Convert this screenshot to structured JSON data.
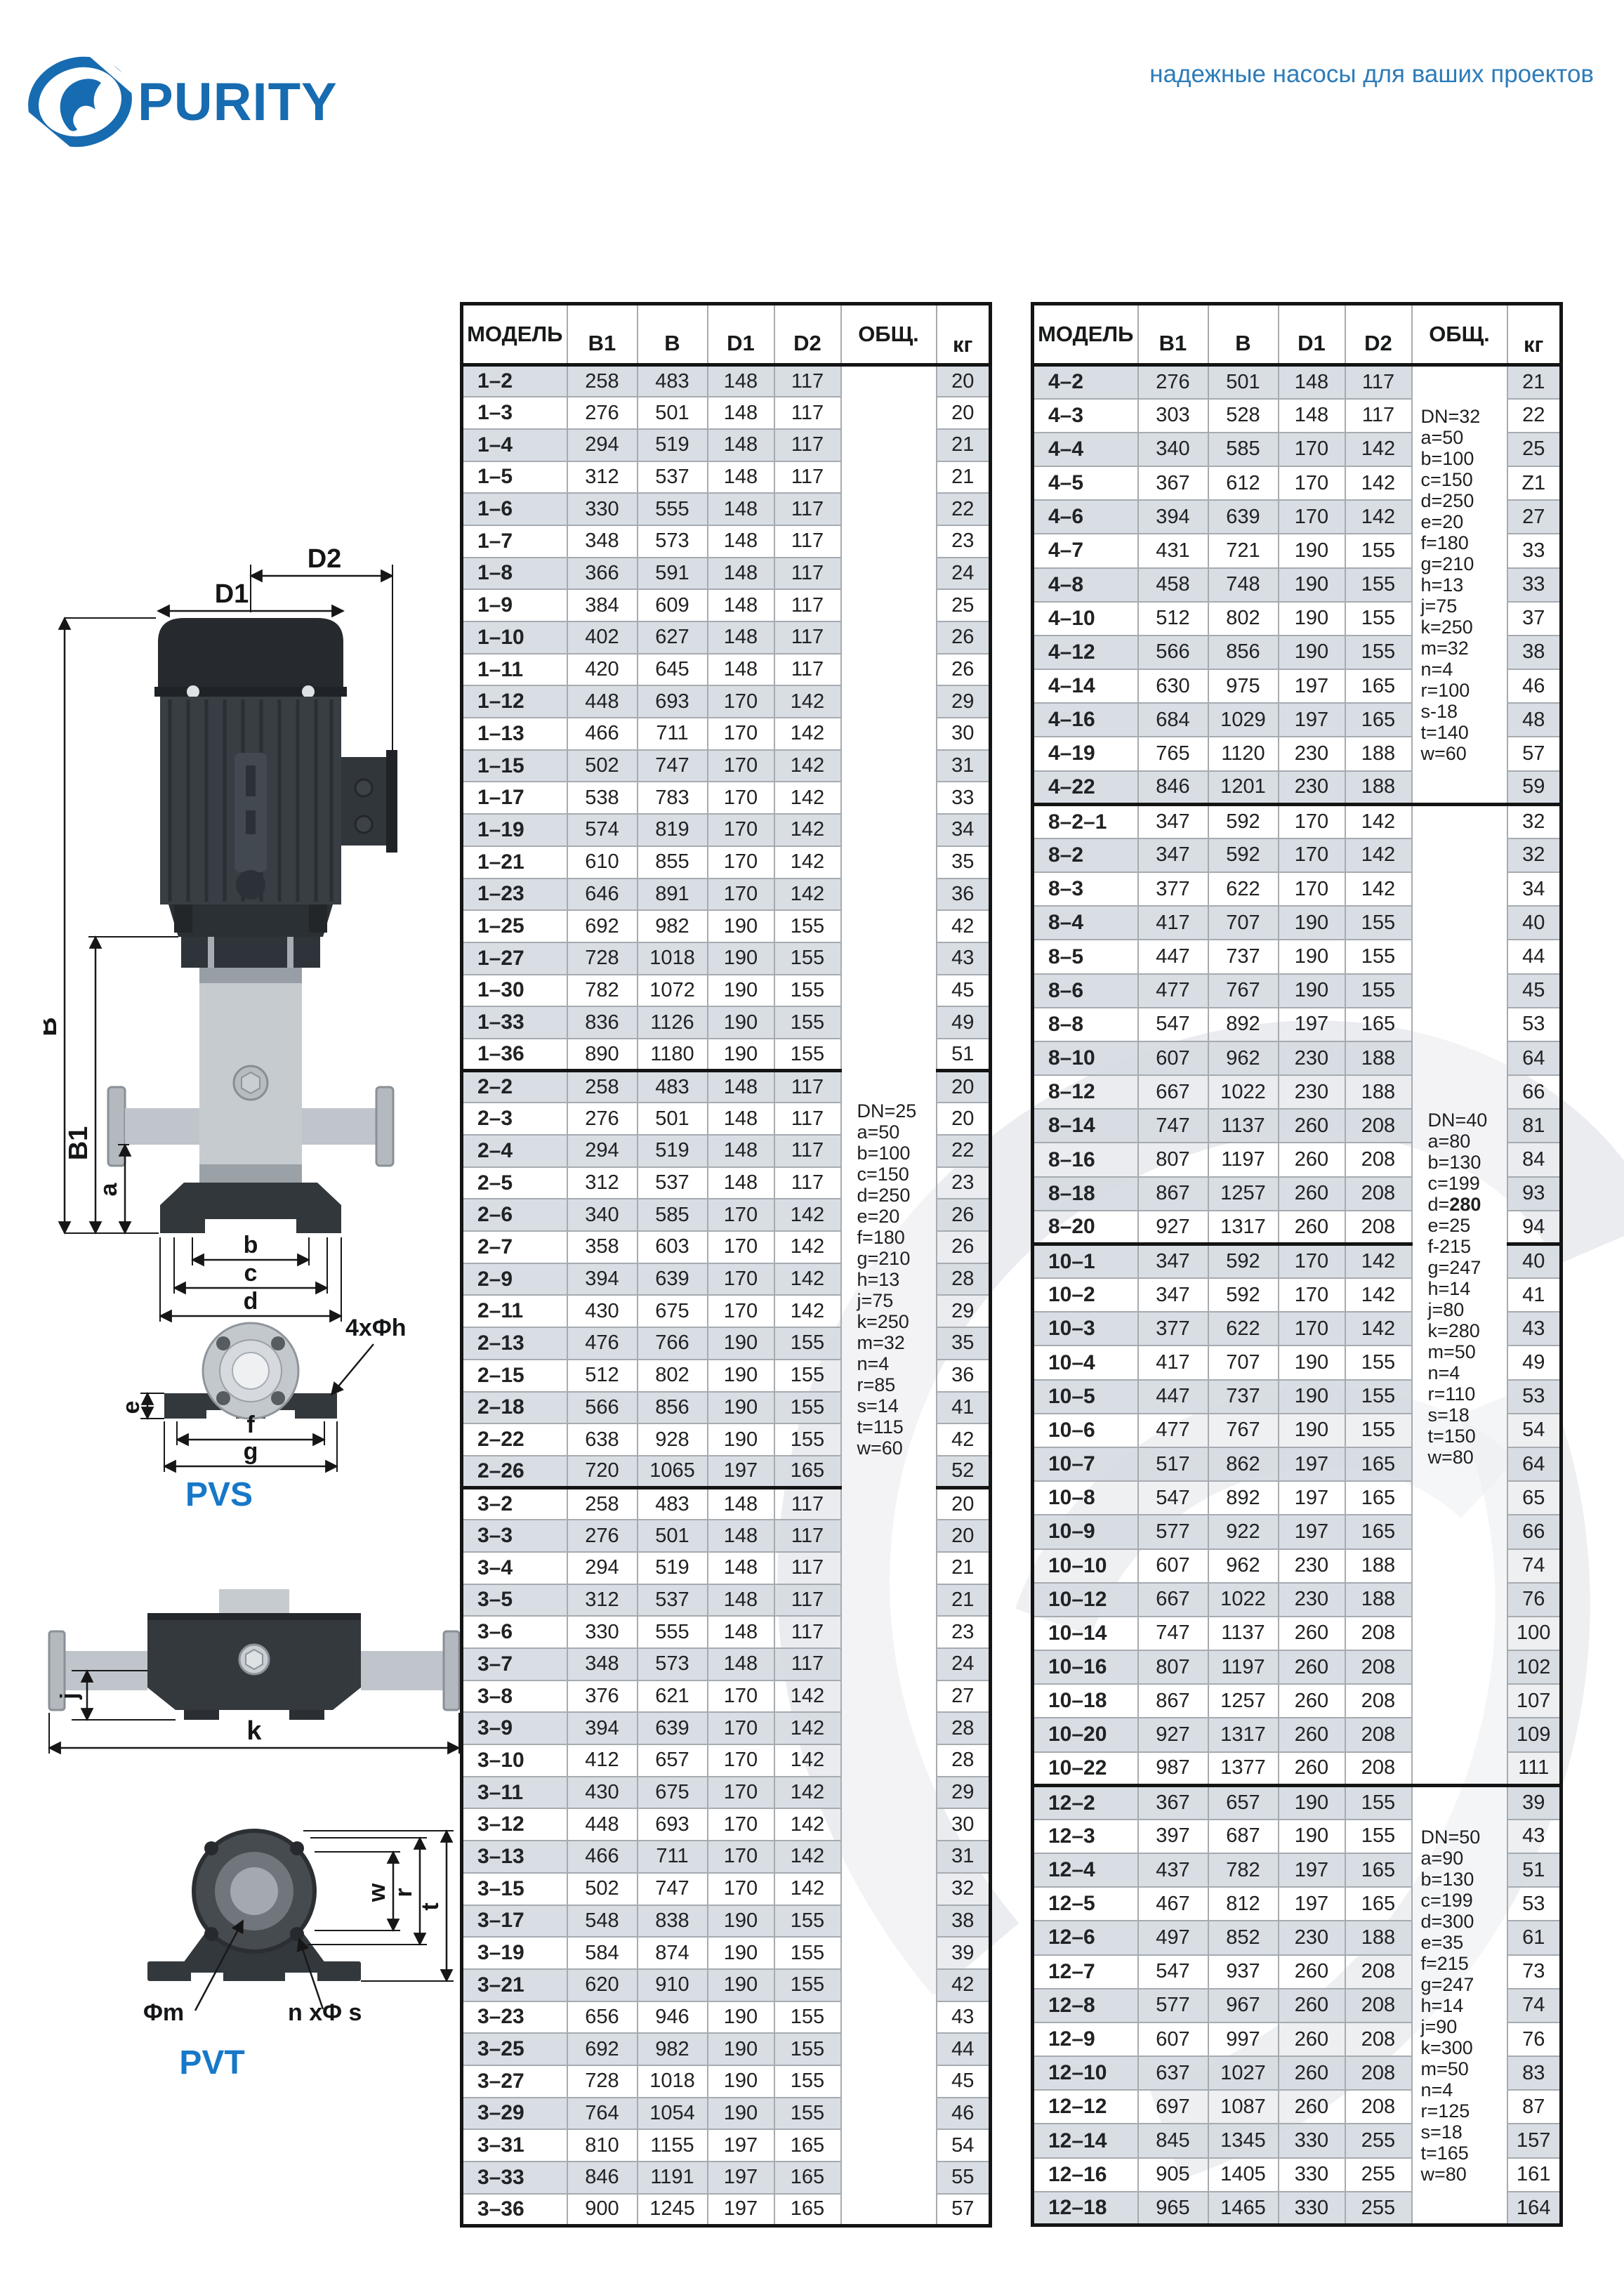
{
  "brand": {
    "logo_text": "PURITY",
    "tagline": "надежные насосы для ваших проектов"
  },
  "diagrams": {
    "pvs": {
      "title": "PVS",
      "dim_d2": "D2",
      "dim_d1": "D1",
      "dim_b": "B",
      "dim_b1": "B1",
      "dim_a": "a",
      "dim_bb": "b",
      "dim_c": "c",
      "dim_d": "d",
      "dim_e": "e",
      "dim_f": "f",
      "dim_g": "g",
      "dim_holes": "4xΦh"
    },
    "pvt": {
      "title": "PVT",
      "dim_j": "j",
      "dim_k": "k",
      "dim_w": "w",
      "dim_r": "r",
      "dim_t": "t",
      "dim_m": "Φm",
      "dim_ns": "n xΦ s"
    }
  },
  "tables": {
    "columns": [
      "МОДЕЛЬ",
      "B1",
      "B",
      "D1",
      "D2",
      "ОБЩ.",
      "кг"
    ],
    "left": {
      "groups": [
        {
          "series": "1",
          "rows": [
            [
              "1–2",
              258,
              483,
              148,
              117,
              20
            ],
            [
              "1–3",
              276,
              501,
              148,
              117,
              20
            ],
            [
              "1–4",
              294,
              519,
              148,
              117,
              21
            ],
            [
              "1–5",
              312,
              537,
              148,
              117,
              21
            ],
            [
              "1–6",
              330,
              555,
              148,
              117,
              22
            ],
            [
              "1–7",
              348,
              573,
              148,
              117,
              23
            ],
            [
              "1–8",
              366,
              591,
              148,
              117,
              24
            ],
            [
              "1–9",
              384,
              609,
              148,
              117,
              25
            ],
            [
              "1–10",
              402,
              627,
              148,
              117,
              26
            ],
            [
              "1–11",
              420,
              645,
              148,
              117,
              26
            ],
            [
              "1–12",
              448,
              693,
              170,
              142,
              29
            ],
            [
              "1–13",
              466,
              711,
              170,
              142,
              30
            ],
            [
              "1–15",
              502,
              747,
              170,
              142,
              31
            ],
            [
              "1–17",
              538,
              783,
              170,
              142,
              33
            ],
            [
              "1–19",
              574,
              819,
              170,
              142,
              34
            ],
            [
              "1–21",
              610,
              855,
              170,
              142,
              35
            ],
            [
              "1–23",
              646,
              891,
              170,
              142,
              36
            ],
            [
              "1–25",
              692,
              982,
              190,
              155,
              42
            ],
            [
              "1–27",
              728,
              1018,
              190,
              155,
              43
            ],
            [
              "1–30",
              782,
              1072,
              190,
              155,
              45
            ],
            [
              "1–33",
              836,
              1126,
              190,
              155,
              49
            ],
            [
              "1–36",
              890,
              1180,
              190,
              155,
              51
            ]
          ],
          "notes": {
            "lines": [
              "DN=25",
              "a=50",
              "b=100",
              "c=150",
              "d=250",
              "e=20",
              "f=180",
              "g=210",
              "h=13",
              "j=75",
              "k=250",
              "m=32",
              "n=4",
              "r=85",
              "s=14",
              "t=115",
              "w=60"
            ],
            "top": "39.5%"
          },
          "notes_rowspan": 58
        },
        {
          "series": "2",
          "rows": [
            [
              "2–2",
              258,
              483,
              148,
              117,
              20
            ],
            [
              "2–3",
              276,
              501,
              148,
              117,
              20
            ],
            [
              "2–4",
              294,
              519,
              148,
              117,
              22
            ],
            [
              "2–5",
              312,
              537,
              148,
              117,
              23
            ],
            [
              "2–6",
              340,
              585,
              170,
              142,
              26
            ],
            [
              "2–7",
              358,
              603,
              170,
              142,
              26
            ],
            [
              "2–9",
              394,
              639,
              170,
              142,
              28
            ],
            [
              "2–11",
              430,
              675,
              170,
              142,
              29
            ],
            [
              "2–13",
              476,
              766,
              190,
              155,
              35
            ],
            [
              "2–15",
              512,
              802,
              190,
              155,
              36
            ],
            [
              "2–18",
              566,
              856,
              190,
              155,
              41
            ],
            [
              "2–22",
              638,
              928,
              190,
              155,
              42
            ],
            [
              "2–26",
              720,
              1065,
              197,
              165,
              52
            ]
          ],
          "notes": null
        },
        {
          "series": "3",
          "rows": [
            [
              "3–2",
              258,
              483,
              148,
              117,
              20
            ],
            [
              "3–3",
              276,
              501,
              148,
              117,
              20
            ],
            [
              "3–4",
              294,
              519,
              148,
              117,
              21
            ],
            [
              "3–5",
              312,
              537,
              148,
              117,
              21
            ],
            [
              "3–6",
              330,
              555,
              148,
              117,
              23
            ],
            [
              "3–7",
              348,
              573,
              148,
              117,
              24
            ],
            [
              "3–8",
              376,
              621,
              170,
              142,
              27
            ],
            [
              "3–9",
              394,
              639,
              170,
              142,
              28
            ],
            [
              "3–10",
              412,
              657,
              170,
              142,
              28
            ],
            [
              "3–11",
              430,
              675,
              170,
              142,
              29
            ],
            [
              "3–12",
              448,
              693,
              170,
              142,
              30
            ],
            [
              "3–13",
              466,
              711,
              170,
              142,
              31
            ],
            [
              "3–15",
              502,
              747,
              170,
              142,
              32
            ],
            [
              "3–17",
              548,
              838,
              190,
              155,
              38
            ],
            [
              "3–19",
              584,
              874,
              190,
              155,
              39
            ],
            [
              "3–21",
              620,
              910,
              190,
              155,
              42
            ],
            [
              "3–23",
              656,
              946,
              190,
              155,
              43
            ],
            [
              "3–25",
              692,
              982,
              190,
              155,
              44
            ],
            [
              "3–27",
              728,
              1018,
              190,
              155,
              45
            ],
            [
              "3–29",
              764,
              1054,
              190,
              155,
              46
            ],
            [
              "3–31",
              810,
              1155,
              197,
              165,
              54
            ],
            [
              "3–33",
              846,
              1191,
              197,
              165,
              55
            ],
            [
              "3–36",
              900,
              1245,
              197,
              165,
              57
            ]
          ],
          "notes": null
        }
      ]
    },
    "right": {
      "groups": [
        {
          "series": "4",
          "rows": [
            [
              "4–2",
              276,
              501,
              148,
              117,
              21
            ],
            [
              "4–3",
              303,
              528,
              148,
              117,
              22
            ],
            [
              "4–4",
              340,
              585,
              170,
              142,
              25
            ],
            [
              "4–5",
              367,
              612,
              170,
              142,
              "Z1"
            ],
            [
              "4–6",
              394,
              639,
              170,
              142,
              27
            ],
            [
              "4–7",
              431,
              721,
              190,
              155,
              33
            ],
            [
              "4–8",
              458,
              748,
              190,
              155,
              33
            ],
            [
              "4–10",
              512,
              802,
              190,
              155,
              37
            ],
            [
              "4–12",
              566,
              856,
              190,
              155,
              38
            ],
            [
              "4–14",
              630,
              975,
              197,
              165,
              46
            ],
            [
              "4–16",
              684,
              1029,
              197,
              165,
              48
            ],
            [
              "4–19",
              765,
              1120,
              230,
              188,
              57
            ],
            [
              "4–22",
              846,
              1201,
              230,
              188,
              59
            ]
          ],
          "notes": {
            "lines": [
              "DN=32",
              "a=50",
              "b=100",
              "c=150",
              "d=250",
              "e=20",
              "f=180",
              "g=210",
              "h=13",
              "j=75",
              "k=250",
              "m=32",
              "n=4",
              "r=100",
              "s-18",
              "t=140",
              "w=60"
            ]
          },
          "notes_rowspan": 13
        },
        {
          "series": "8",
          "rows": [
            [
              "8–2–1",
              347,
              592,
              170,
              142,
              32
            ],
            [
              "8–2",
              347,
              592,
              170,
              142,
              32
            ],
            [
              "8–3",
              377,
              622,
              170,
              142,
              34
            ],
            [
              "8–4",
              417,
              707,
              190,
              155,
              40
            ],
            [
              "8–5",
              447,
              737,
              190,
              155,
              44
            ],
            [
              "8–6",
              477,
              767,
              190,
              155,
              45
            ],
            [
              "8–8",
              547,
              892,
              197,
              165,
              53
            ],
            [
              "8–10",
              607,
              962,
              230,
              188,
              64
            ],
            [
              "8–12",
              667,
              1022,
              230,
              188,
              66
            ],
            [
              "8–14",
              747,
              1137,
              260,
              208,
              81
            ],
            [
              "8–16",
              807,
              1197,
              260,
              208,
              84
            ],
            [
              "8–18",
              867,
              1257,
              260,
              208,
              93
            ],
            [
              "8–20",
              927,
              1317,
              260,
              208,
              94
            ]
          ],
          "notes": {
            "lines": [
              "DN=40",
              "a=80",
              "b=130",
              "c=199",
              "d=280",
              "e=25",
              "f-215",
              "g=247",
              "h=14",
              "j=80",
              "k=280",
              "m=50",
              "n=4",
              "r=110",
              "s=18",
              "t=150",
              "w=80"
            ],
            "top": "31%",
            "bold_line": 4
          },
          "notes_rowspan": 29
        },
        {
          "series": "10",
          "rows": [
            [
              "10–1",
              347,
              592,
              170,
              142,
              40
            ],
            [
              "10–2",
              347,
              592,
              170,
              142,
              41
            ],
            [
              "10–3",
              377,
              622,
              170,
              142,
              43
            ],
            [
              "10–4",
              417,
              707,
              190,
              155,
              49
            ],
            [
              "10–5",
              447,
              737,
              190,
              155,
              53
            ],
            [
              "10–6",
              477,
              767,
              190,
              155,
              54
            ],
            [
              "10–7",
              517,
              862,
              197,
              165,
              64
            ],
            [
              "10–8",
              547,
              892,
              197,
              165,
              65
            ],
            [
              "10–9",
              577,
              922,
              197,
              165,
              66
            ],
            [
              "10–10",
              607,
              962,
              230,
              188,
              74
            ],
            [
              "10–12",
              667,
              1022,
              230,
              188,
              76
            ],
            [
              "10–14",
              747,
              1137,
              260,
              208,
              100
            ],
            [
              "10–16",
              807,
              1197,
              260,
              208,
              102
            ],
            [
              "10–18",
              867,
              1257,
              260,
              208,
              107
            ],
            [
              "10–20",
              927,
              1317,
              260,
              208,
              109
            ],
            [
              "10–22",
              987,
              1377,
              260,
              208,
              111
            ]
          ],
          "notes": null
        },
        {
          "series": "12",
          "rows": [
            [
              "12–2",
              367,
              657,
              190,
              155,
              39
            ],
            [
              "12–3",
              397,
              687,
              190,
              155,
              43
            ],
            [
              "12–4",
              437,
              782,
              197,
              165,
              51
            ],
            [
              "12–5",
              467,
              812,
              197,
              165,
              53
            ],
            [
              "12–6",
              497,
              852,
              230,
              188,
              61
            ],
            [
              "12–7",
              547,
              937,
              260,
              208,
              73
            ],
            [
              "12–8",
              577,
              967,
              260,
              208,
              74
            ],
            [
              "12–9",
              607,
              997,
              260,
              208,
              76
            ],
            [
              "12–10",
              637,
              1027,
              260,
              208,
              83
            ],
            [
              "12–12",
              697,
              1087,
              260,
              208,
              87
            ],
            [
              "12–14",
              845,
              1345,
              330,
              255,
              157
            ],
            [
              "12–16",
              905,
              1405,
              330,
              255,
              161
            ],
            [
              "12–18",
              965,
              1465,
              330,
              255,
              164
            ]
          ],
          "notes": {
            "lines": [
              "DN=50",
              "a=90",
              "b=130",
              "c=199",
              "d=300",
              "e=35",
              "f=215",
              "g=247",
              "h=14",
              "j=90",
              "k=300",
              "m=50",
              "n=4",
              "r=125",
              "s=18",
              "t=165",
              "w=80"
            ]
          },
          "notes_rowspan": 13
        }
      ]
    }
  }
}
